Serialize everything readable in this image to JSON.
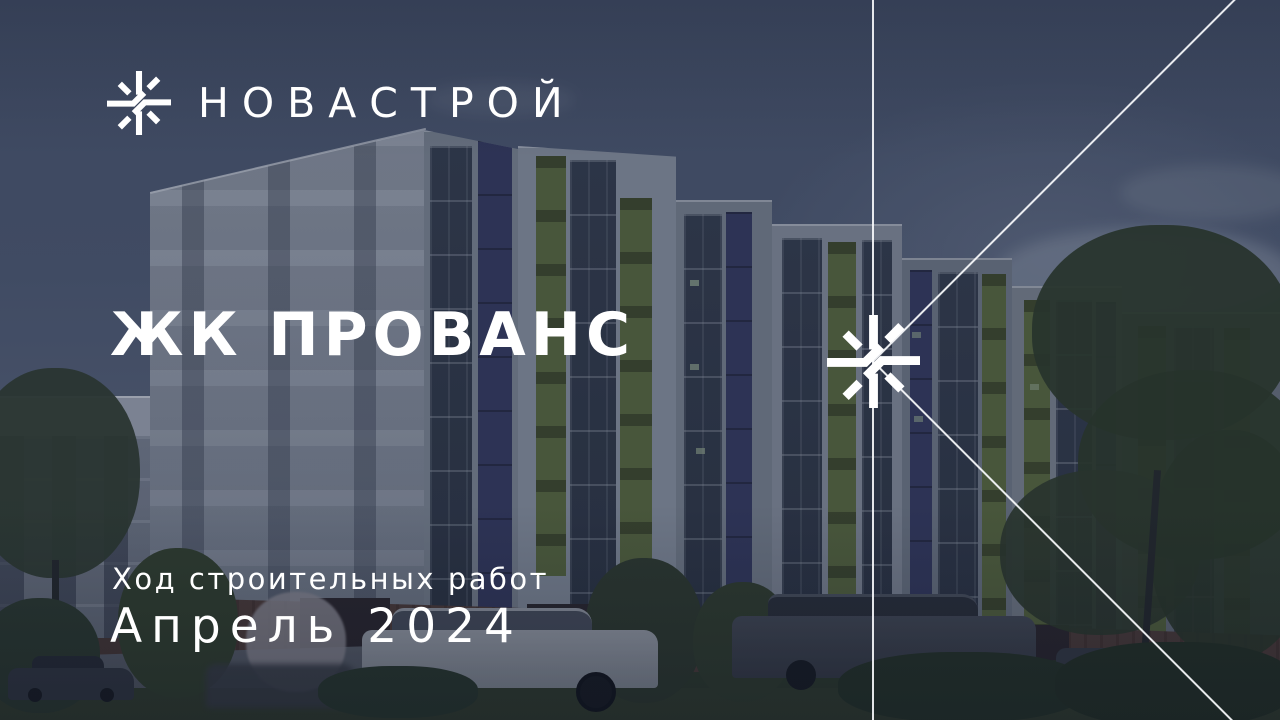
{
  "brand": {
    "name": "НОВАСТРОЙ"
  },
  "hero": {
    "title": "ЖК ПРОВАНС",
    "subtitle": "Ход строительных работ",
    "period": "Апрель 2024"
  },
  "scene": {
    "description": "Rendering of a residential complex with dark navy overlay",
    "storefront_signs": [
      "ека",
      "кофе",
      "цветы"
    ]
  },
  "colors": {
    "text": "#ffffff",
    "sky": "#4a5870",
    "overlay_navy": "#17203a",
    "accent_navy": "#343b60",
    "accent_green": "#57683f",
    "brick": "#503e3a"
  }
}
